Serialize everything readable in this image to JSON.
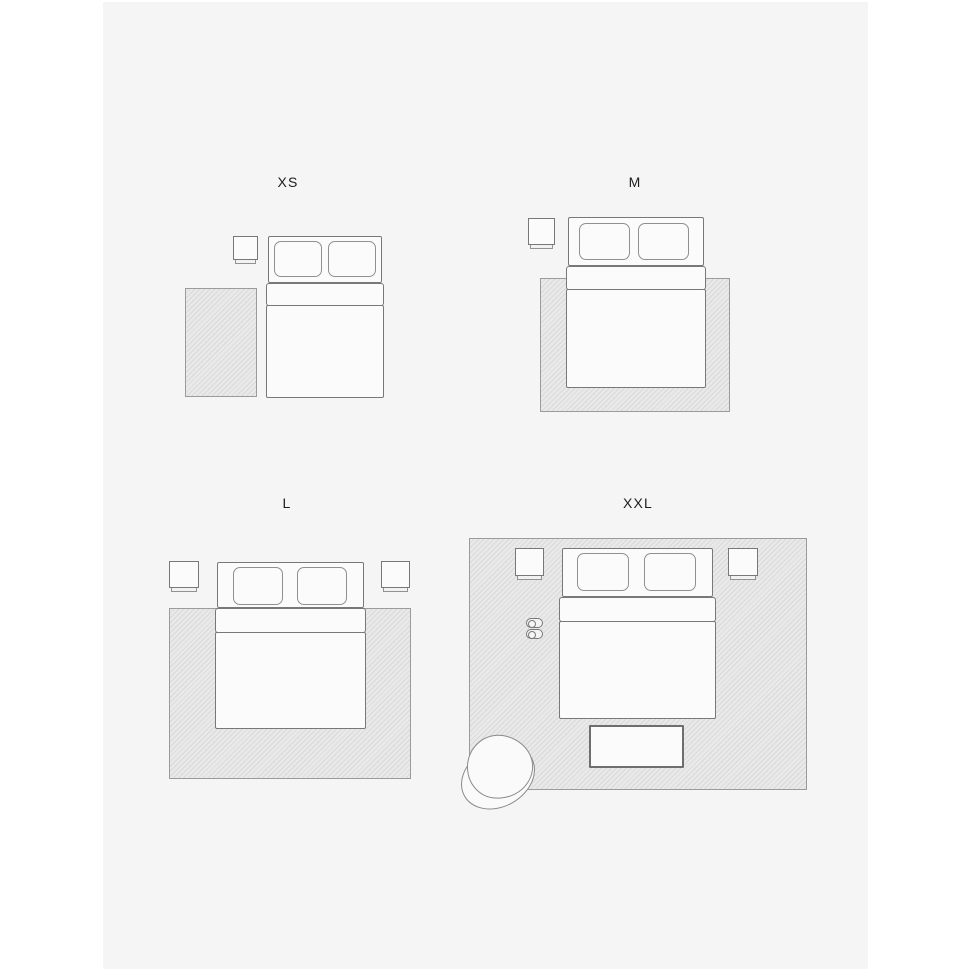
{
  "size_guide": {
    "description": "Rug size guide illustration with four bedroom floor plans",
    "panels": [
      {
        "id": "xs",
        "label": "XS"
      },
      {
        "id": "m",
        "label": "M"
      },
      {
        "id": "l",
        "label": "L"
      },
      {
        "id": "xxl",
        "label": "XXL"
      }
    ],
    "icons": {
      "bed": "css-rect-with-pillows",
      "nightstand": "css-square-with-lip",
      "rug": "css-hatched-rect",
      "bench": "css-rect",
      "armchair": "css-overlapping-ellipses",
      "slippers": "css-capsules"
    }
  },
  "colors": {
    "canvas": "#ffffff",
    "panel_background": "#f5f5f5",
    "furniture_fill": "#fbfbfb",
    "furniture_outline": "#787878",
    "rug_fill": "#e9e9e9",
    "rug_hatch": "#d9d9d9",
    "rug_border": "#9b9b9b",
    "label_text": "#1d1d1d"
  }
}
